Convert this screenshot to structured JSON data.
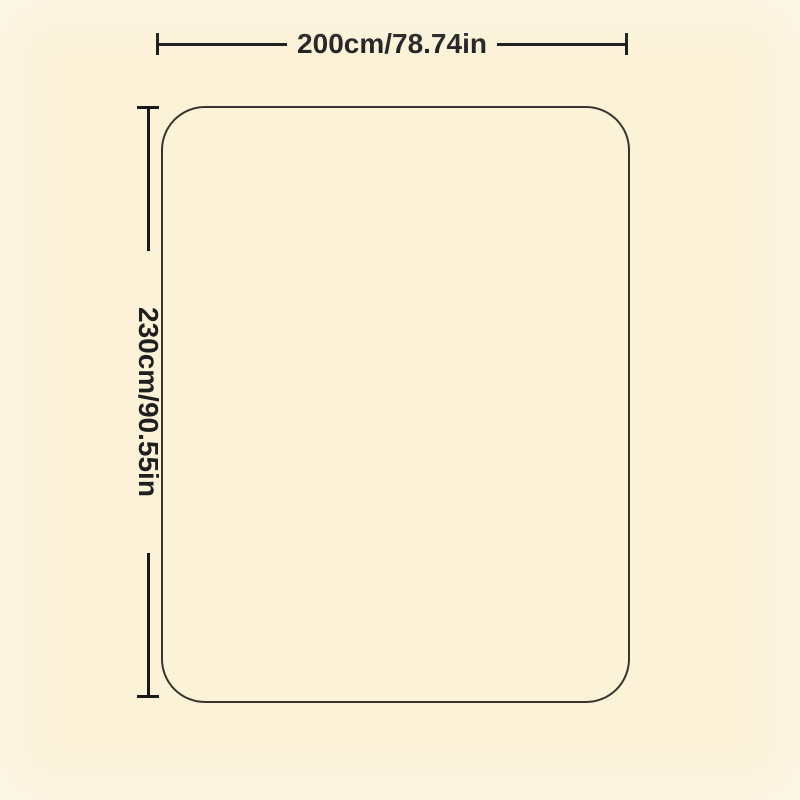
{
  "colors": {
    "background": "#fbf2d8",
    "outline": "#3b332c",
    "dimension-line": "#181818",
    "text": "#1f1f1f"
  },
  "diagram": {
    "width_dimension": {
      "label": "200cm/78.74in"
    },
    "height_dimension": {
      "label": "230cm/90.55in"
    }
  }
}
